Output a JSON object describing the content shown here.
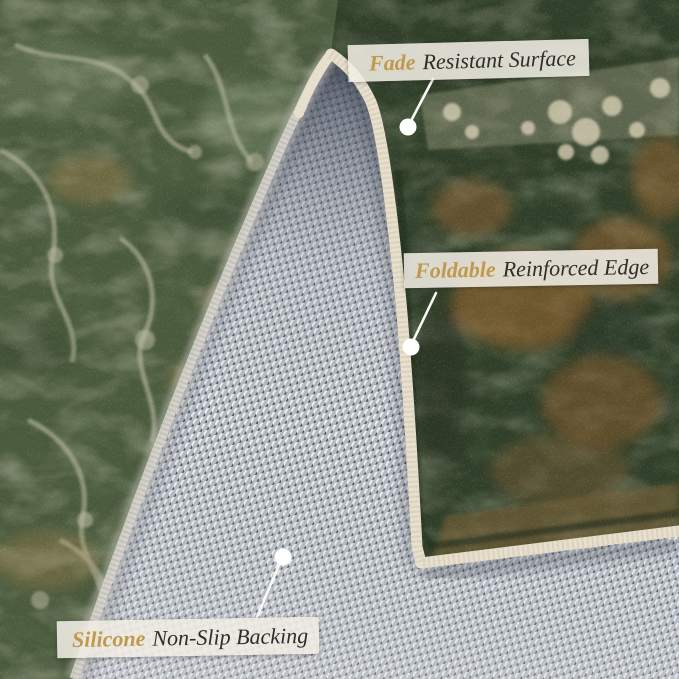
{
  "photo": {
    "subject": "rug-corner-folded-showing-backing"
  },
  "callouts": [
    {
      "id": "fade",
      "highlight": "Fade",
      "rest": "Resistant Surface"
    },
    {
      "id": "foldable",
      "highlight": "Foldable",
      "rest": "Reinforced Edge"
    },
    {
      "id": "silicone",
      "highlight": "Silicone",
      "rest": "Non-Slip Backing"
    }
  ],
  "colors": {
    "gold": "#c0994e",
    "ink": "#2e2d29",
    "label-bg": "rgba(240,237,228,0.88)",
    "marker": "#ffffff",
    "line": "#f8f8f4",
    "rug-green": "#4a5a3d",
    "rug-motif": "#c3c0a8",
    "folded-green": "#2f3e28",
    "backing-gray": "#b4b9c0",
    "binding": "#e8e0cd"
  }
}
